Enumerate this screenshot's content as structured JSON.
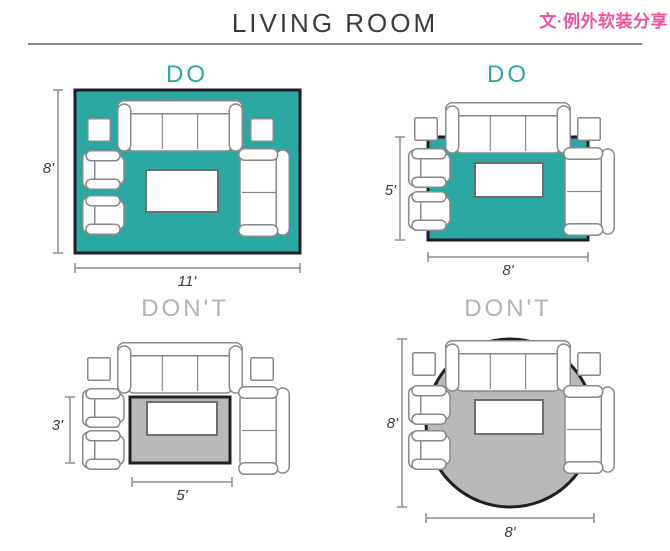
{
  "header": {
    "title": "LIVING ROOM",
    "watermark": "文·例外软装分享"
  },
  "colors": {
    "rug_teal": "#2CA8A2",
    "rug_gray": "#B9B9B9",
    "rug_border": "#211D27",
    "do_label": "#2CA8A2",
    "dont_label": "#B3B3B3",
    "furniture_outline": "#8A8A8A",
    "dimension_line": "#8D8D8D",
    "text_dark": "#3E3A39",
    "watermark_pink": "#ED539E"
  },
  "panels": [
    {
      "verdict": "DO",
      "rug_shape": "rectangle",
      "rug_color": "teal",
      "height_label": "8'",
      "width_label": "11'",
      "furniture": [
        "sofa",
        "side-table",
        "side-table",
        "armchair",
        "armchair",
        "loveseat",
        "coffee-table"
      ]
    },
    {
      "verdict": "DO",
      "rug_shape": "rectangle",
      "rug_color": "teal",
      "height_label": "5'",
      "width_label": "8'",
      "furniture": [
        "sofa",
        "side-table",
        "side-table",
        "armchair",
        "armchair",
        "loveseat",
        "coffee-table"
      ]
    },
    {
      "verdict": "DON'T",
      "rug_shape": "rectangle",
      "rug_color": "gray",
      "height_label": "3'",
      "width_label": "5'",
      "furniture": [
        "sofa",
        "side-table",
        "side-table",
        "armchair",
        "armchair",
        "loveseat",
        "coffee-table"
      ]
    },
    {
      "verdict": "DON'T",
      "rug_shape": "round",
      "rug_color": "gray",
      "height_label": "8'",
      "width_label": "8'",
      "furniture": [
        "sofa",
        "side-table",
        "side-table",
        "armchair",
        "armchair",
        "loveseat",
        "coffee-table"
      ]
    }
  ]
}
